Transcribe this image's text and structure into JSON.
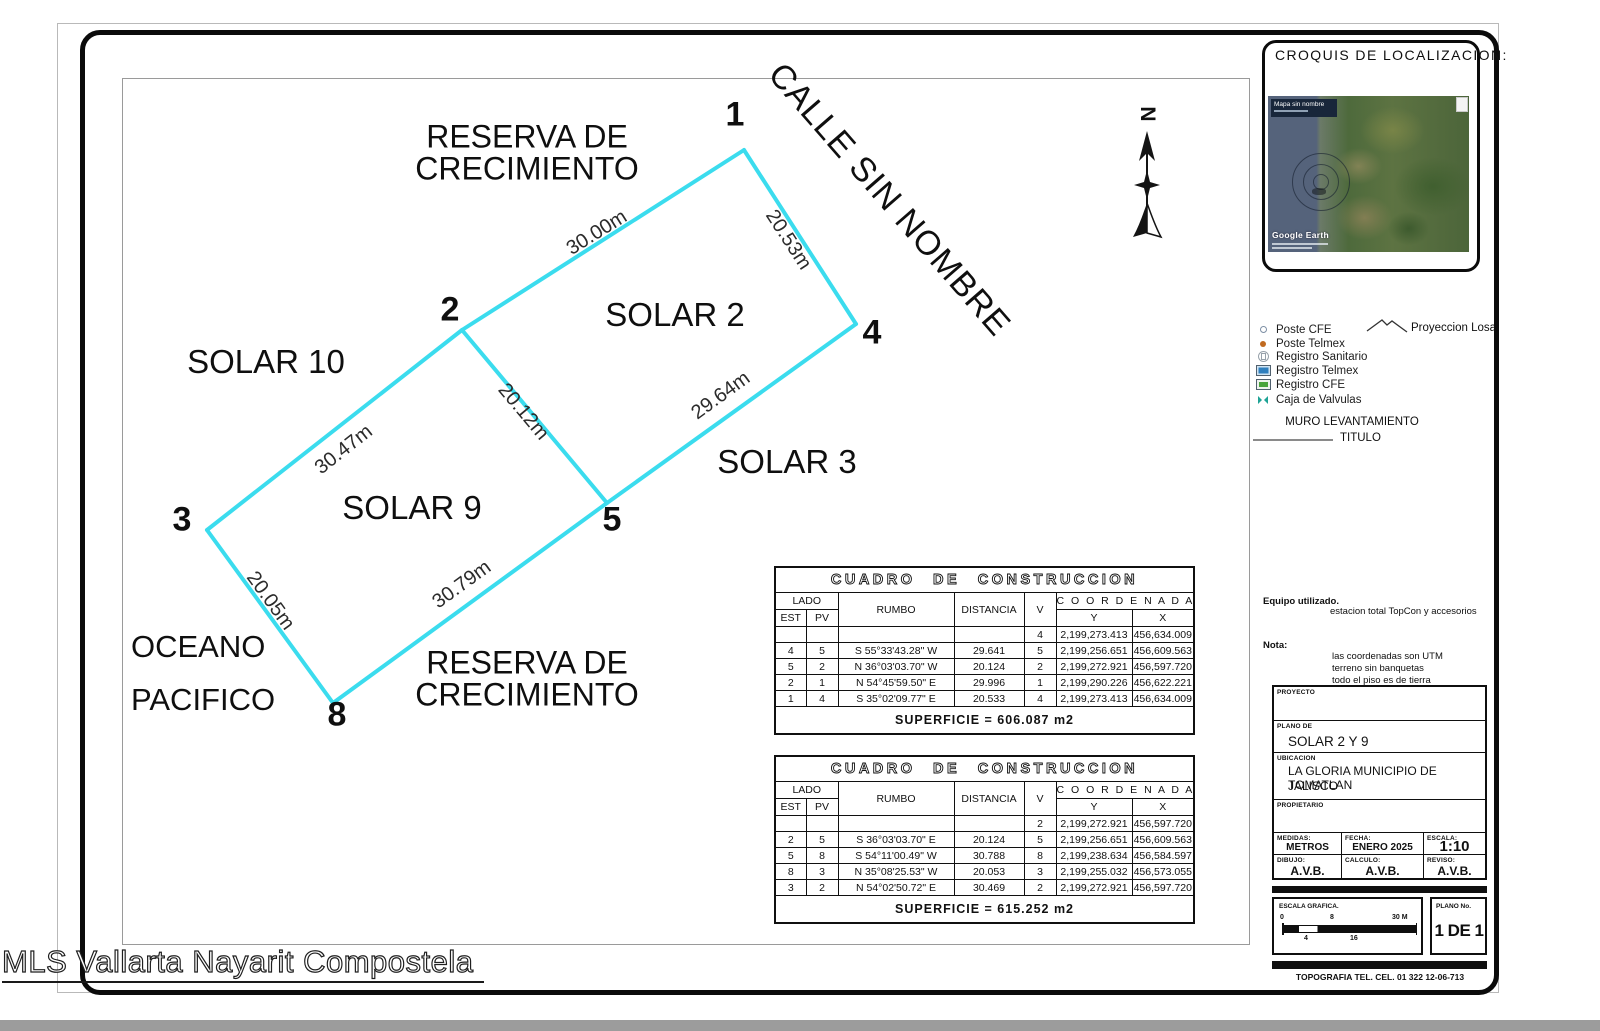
{
  "colors": {
    "line": "#3bdcee",
    "border": "#0b0b0b",
    "bottom_bar": "#9c9c9c"
  },
  "page": {
    "watermark": "MLS Vallarta Nayarit Compostela"
  },
  "plan": {
    "reserva_line1": "RESERVA DE",
    "reserva_line2": "CRECIMIENTO",
    "calle": "CALLE SIN NOMBRE",
    "solar2": "SOLAR 2",
    "solar3": "SOLAR 3",
    "solar9": "SOLAR 9",
    "solar10": "SOLAR 10",
    "oceano_line1": "OCEANO",
    "oceano_line2": "PACIFICO",
    "north_label": "N",
    "vertices": {
      "v1": "1",
      "v2": "2",
      "v3": "3",
      "v4": "4",
      "v5": "5",
      "v8": "8"
    },
    "measures": {
      "m12": "30.00m",
      "m14": "20.53m",
      "m25": "20.12m",
      "m45": "29.64m",
      "m23": "30.47m",
      "m38": "20.05m",
      "m85": "30.79m"
    }
  },
  "tables": [
    {
      "title": "CUADRO DE CONSTRUCCION",
      "col_lado": "LADO",
      "col_est": "EST",
      "col_pv": "PV",
      "col_rumbo": "RUMBO",
      "col_distancia": "DISTANCIA",
      "col_v": "V",
      "col_coordenadas": "C O O R D E N A D A S",
      "col_y": "Y",
      "col_x": "X",
      "rows": [
        [
          "",
          "",
          "",
          "",
          "4",
          "2,199,273.413",
          "456,634.009"
        ],
        [
          "4",
          "5",
          "S 55°33'43.28\" W",
          "29.641",
          "5",
          "2,199,256.651",
          "456,609.563"
        ],
        [
          "5",
          "2",
          "N 36°03'03.70\" W",
          "20.124",
          "2",
          "2,199,272.921",
          "456,597.720"
        ],
        [
          "2",
          "1",
          "N 54°45'59.50\" E",
          "29.996",
          "1",
          "2,199,290.226",
          "456,622.221"
        ],
        [
          "1",
          "4",
          "S 35°02'09.77\" E",
          "20.533",
          "4",
          "2,199,273.413",
          "456,634.009"
        ]
      ],
      "superficie": "SUPERFICIE = 606.087 m2"
    },
    {
      "title": "CUADRO DE CONSTRUCCION",
      "col_lado": "LADO",
      "col_est": "EST",
      "col_pv": "PV",
      "col_rumbo": "RUMBO",
      "col_distancia": "DISTANCIA",
      "col_v": "V",
      "col_coordenadas": "C O O R D E N A D A S",
      "col_y": "Y",
      "col_x": "X",
      "rows": [
        [
          "",
          "",
          "",
          "",
          "2",
          "2,199,272.921",
          "456,597.720"
        ],
        [
          "2",
          "5",
          "S 36°03'03.70\" E",
          "20.124",
          "5",
          "2,199,256.651",
          "456,609.563"
        ],
        [
          "5",
          "8",
          "S 54°11'00.49\" W",
          "30.788",
          "8",
          "2,199,238.634",
          "456,584.597"
        ],
        [
          "8",
          "3",
          "N 35°08'25.53\" W",
          "20.053",
          "3",
          "2,199,255.032",
          "456,573.055"
        ],
        [
          "3",
          "2",
          "N 54°02'50.72\" E",
          "30.469",
          "2",
          "2,199,272.921",
          "456,597.720"
        ]
      ],
      "superficie": "SUPERFICIE = 615.252 m2"
    }
  ],
  "croquis": {
    "title": "CROQUIS DE LOCALIZACION:",
    "map_label": "Mapa sin nombre",
    "map_credit": "Google Earth"
  },
  "legend": {
    "items": [
      "Poste CFE",
      "Poste Telmex",
      "Registro Sanitario",
      "Registro Telmex",
      "Registro CFE",
      "Caja de Valvulas"
    ],
    "proyeccion": "Proyeccion Losa",
    "muro": "MURO LEVANTAMIENTO",
    "titulo": "TITULO"
  },
  "notes": {
    "equipo_label": "Equipo utilizado.",
    "equipo_value": "estacion total TopCon y accesorios",
    "nota_label": "Nota:",
    "nota_line1": "las coordenadas son UTM",
    "nota_line2": "terreno sin banquetas",
    "nota_line3": "todo el piso es de tierra"
  },
  "titleblock": {
    "proyecto_label": "PROYECTO",
    "plano_de_label": "PLANO DE",
    "plano_de_value": "SOLAR 2 Y 9",
    "ubicacion_label": "UBICACION",
    "ubicacion_line1": "LA GLORIA MUNICIPIO DE TOMATLAN",
    "ubicacion_line2": "JALISCO",
    "propietario_label": "PROPIETARIO",
    "medidas_label": "MEDIDAS:",
    "medidas_value": "METROS",
    "fecha_label": "FECHA:",
    "fecha_value": "ENERO 2025",
    "escala_label": "ESCALA:",
    "escala_value": "1:10",
    "dibujo_label": "DIBUJO:",
    "dibujo_value": "A.V.B.",
    "calculo_label": "CALCULO:",
    "calculo_value": "A.V.B.",
    "reviso_label": "REVISO:",
    "reviso_value": "A.V.B."
  },
  "footer": {
    "escala_grafica_label": "ESCALA GRAFICA.",
    "ticks": {
      "t0": "0",
      "t4": "4",
      "t8": "8",
      "t16": "16",
      "t30": "30 M"
    },
    "plano_no_label": "PLANO No.",
    "plano_no_value": "1 DE 1",
    "contact": "TOPOGRAFIA TEL. CEL. 01 322  12-06-713"
  }
}
